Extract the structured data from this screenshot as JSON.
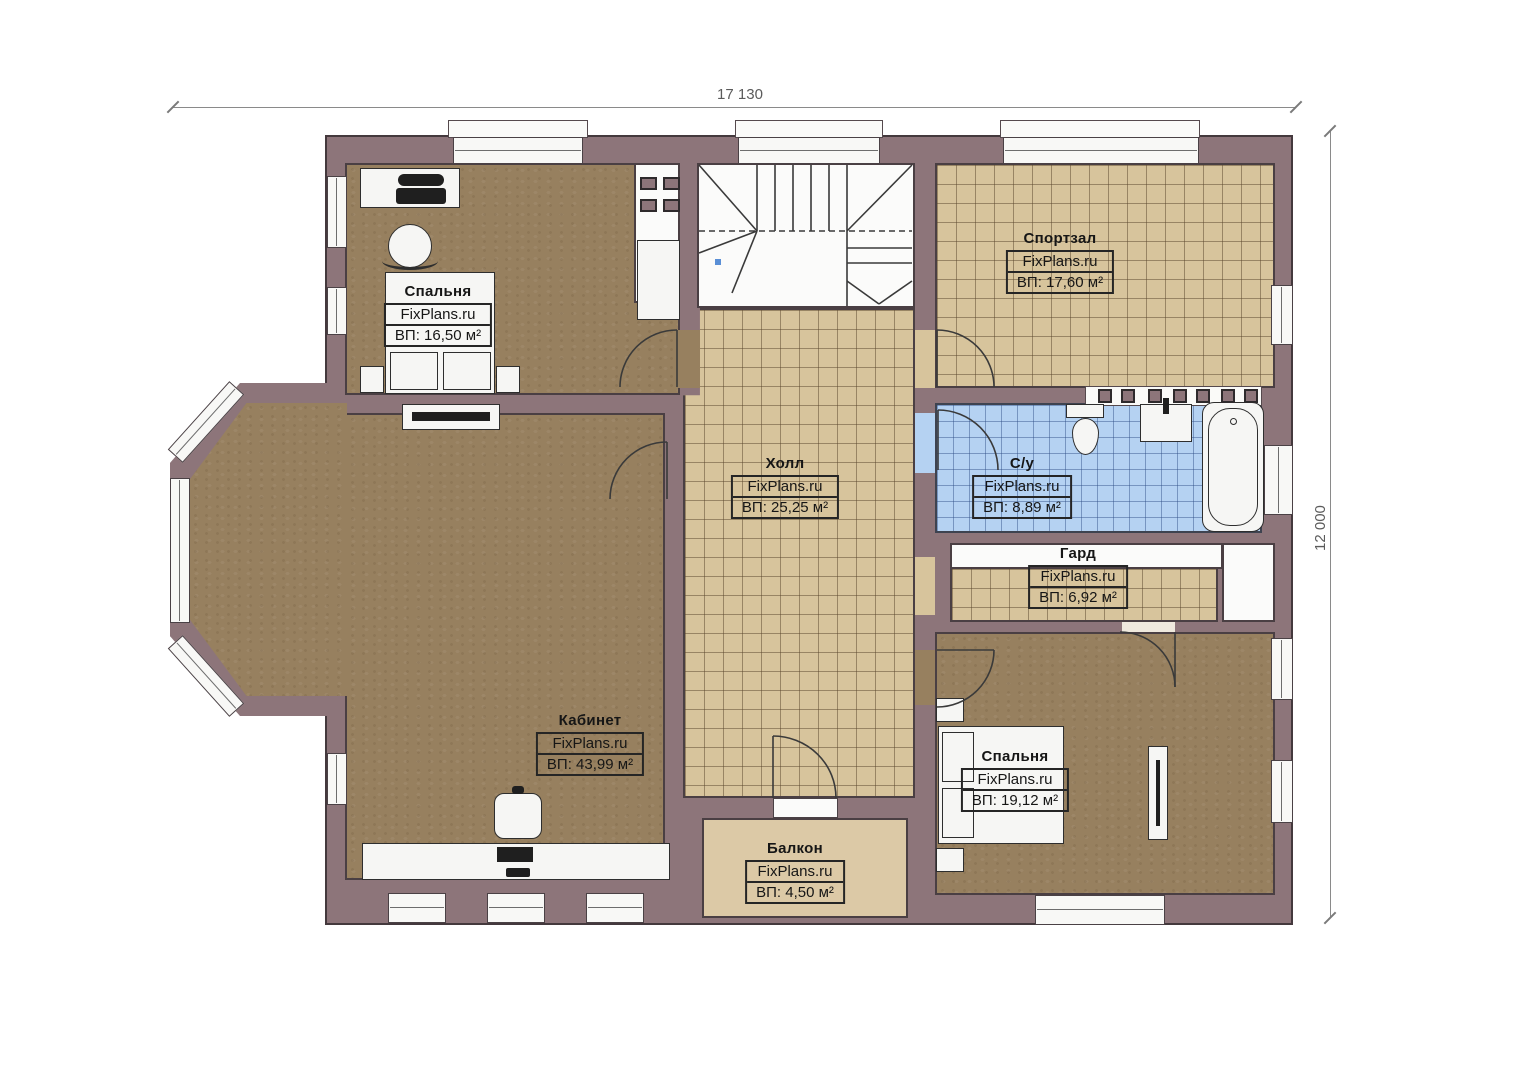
{
  "dimensions": {
    "width_label": "17 130",
    "height_label": "12 000"
  },
  "rooms": [
    {
      "id": "bedroom-1",
      "name": "Спальня",
      "brand": "FixPlans.ru",
      "area": "ВП: 16,50 м²"
    },
    {
      "id": "gym",
      "name": "Спортзал",
      "brand": "FixPlans.ru",
      "area": "ВП: 17,60 м²"
    },
    {
      "id": "hall",
      "name": "Холл",
      "brand": "FixPlans.ru",
      "area": "ВП: 25,25 м²"
    },
    {
      "id": "bathroom",
      "name": "С/у",
      "brand": "FixPlans.ru",
      "area": "ВП: 8,89 м²"
    },
    {
      "id": "wardrobe",
      "name": "Гард",
      "brand": "FixPlans.ru",
      "area": "ВП: 6,92 м²"
    },
    {
      "id": "office",
      "name": "Кабинет",
      "brand": "FixPlans.ru",
      "area": "ВП: 43,99 м²"
    },
    {
      "id": "bedroom-2",
      "name": "Спальня",
      "brand": "FixPlans.ru",
      "area": "ВП: 19,12 м²"
    },
    {
      "id": "balcony",
      "name": "Балкон",
      "brand": "FixPlans.ru",
      "area": "ВП: 4,50 м²"
    }
  ],
  "colors": {
    "wall": "#8d757a",
    "carpet": "#97805f",
    "tile": "#d7c49c",
    "tile_blue": "#b5d2f2",
    "balcony": "#dcc9a6"
  }
}
